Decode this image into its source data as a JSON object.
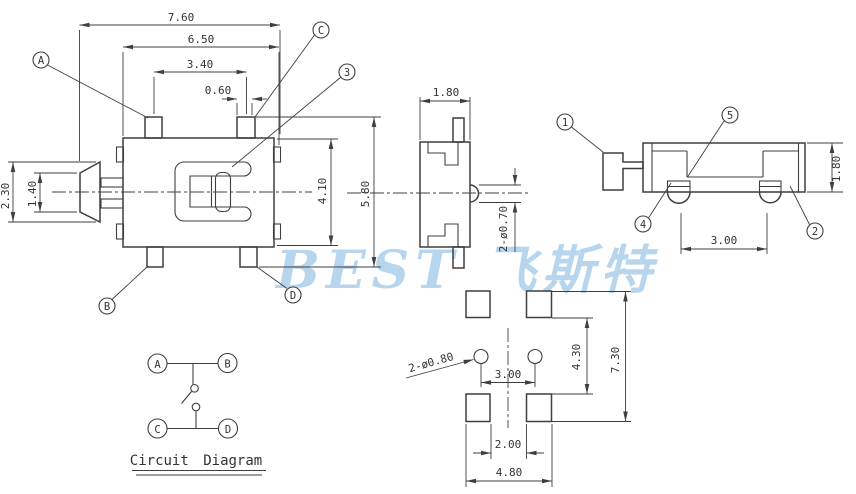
{
  "watermark": {
    "text": "BEST 飞斯特",
    "color": "#b7d6ee"
  },
  "front": {
    "dim_overall_width": "7.60",
    "dim_body_width": "6.50",
    "dim_pad_pitch": "3.40",
    "dim_pad_width": "0.60",
    "dim_knob_height": "2.30",
    "dim_knob_tip": "1.40",
    "dim_body_height": "4.10",
    "dim_overall_height": "5.80",
    "balloon_a": "A",
    "balloon_b": "B",
    "balloon_c": "C",
    "balloon_d": "D",
    "balloon_3": "3"
  },
  "side": {
    "dim_width": "1.80",
    "dim_pin_dia": "2-ø0.70"
  },
  "rear": {
    "dim_height": "1.80",
    "dim_pin_pitch": "3.00",
    "balloon_1": "1",
    "balloon_2": "2",
    "balloon_4": "4",
    "balloon_5": "5"
  },
  "footprint": {
    "dim_hole_dia": "2-ø0.80",
    "dim_hole_pitch": "3.00",
    "dim_pad_gap": "4.30",
    "dim_overall_height": "7.30",
    "dim_slot_width": "2.00",
    "dim_overall_width": "4.80"
  },
  "circuit": {
    "title": "Circuit Diagram",
    "term_a": "A",
    "term_b": "B",
    "term_c": "C",
    "term_d": "D"
  }
}
